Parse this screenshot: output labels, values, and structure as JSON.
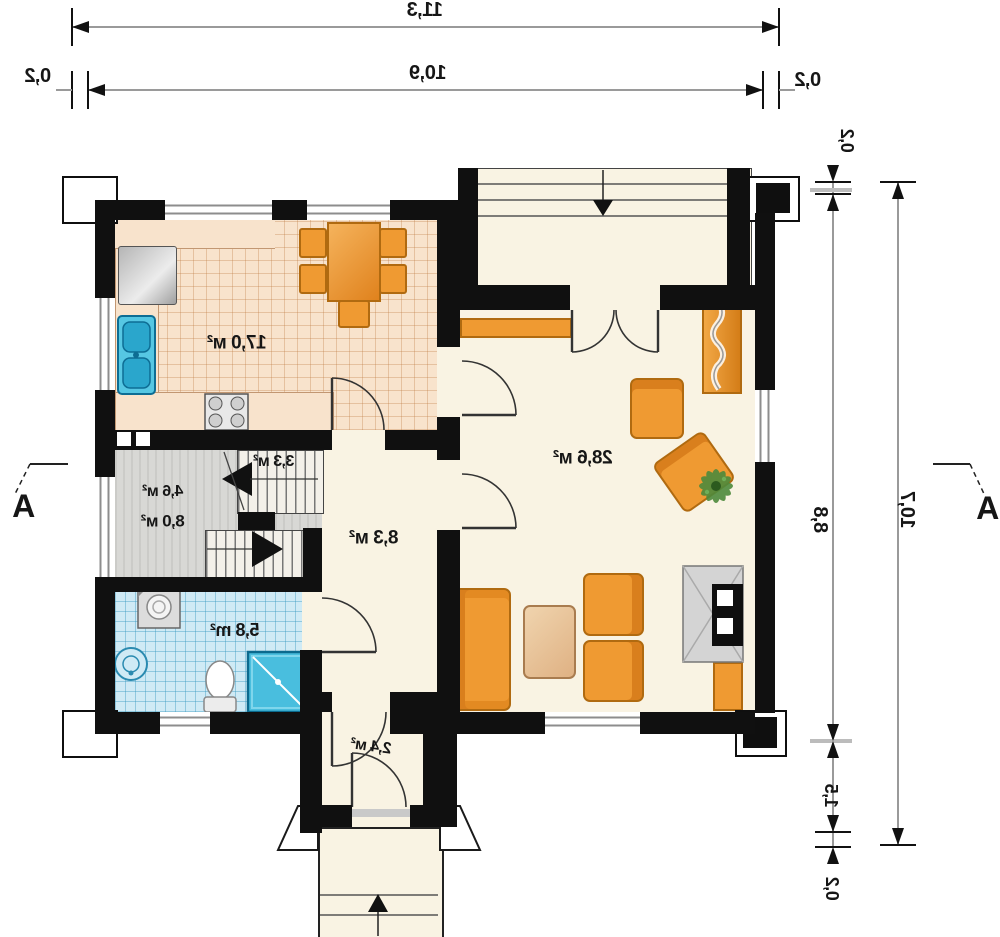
{
  "title": "ground-floor-plan-mirrored",
  "rooms": {
    "kitchen": "17,0 м²",
    "living": "28,6 м²",
    "hall": "8,3 м²",
    "landing": "3,3 м²",
    "stairs_upper": "4,6 м²",
    "stairs_lower": "8,0 м²",
    "bathroom": "5,8 m²",
    "vestibule": "2,4 м²"
  },
  "dims": {
    "total_w": "11,3",
    "inner_w": "10,9",
    "wall_l": "0,2",
    "wall_r": "0,2",
    "wall_t": "0,2",
    "inner_h": "8,8",
    "porch_h": "1,5",
    "wall_b": "0,2",
    "total_h": "10,7"
  },
  "sections": {
    "left": "A",
    "right": "A"
  },
  "colors": {
    "wall": "#101010",
    "floor": "#f9f3e3",
    "kitchen_tile": "#f8e3cc",
    "bath_tile": "#cfeaf5",
    "stairs_floor": "#d8d8d5",
    "furniture": "#ef9a32",
    "furniture_dark": "#b06a10",
    "water": "#49bede",
    "dim_line": "#9a9a9a"
  }
}
